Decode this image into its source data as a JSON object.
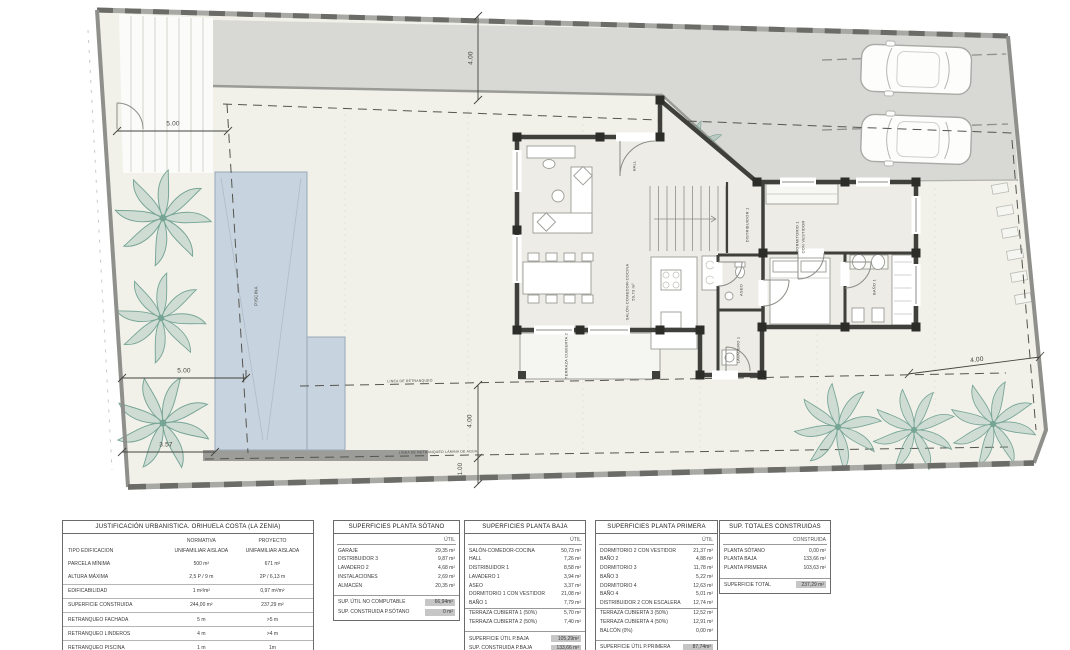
{
  "colors": {
    "pool": "#c7d3de",
    "street": "#d8d8d4",
    "garden": "#f1f1ea",
    "wall": "#3f3f3b",
    "tree": "#76a596",
    "table_shade": "#c6c6c6"
  },
  "plan": {
    "labels": [
      {
        "text": "4.00",
        "x": 471,
        "y": 58,
        "r": -90,
        "fs": 6.5
      },
      {
        "text": "5.00",
        "x": 173,
        "y": 124,
        "r": 0,
        "fs": 6.5
      },
      {
        "text": "5.00",
        "x": 184,
        "y": 371,
        "r": 0,
        "fs": 6.5
      },
      {
        "text": "3.57",
        "x": 166,
        "y": 445,
        "r": 0,
        "fs": 6.5
      },
      {
        "text": "4.00",
        "x": 470,
        "y": 421,
        "r": -90,
        "fs": 6.5
      },
      {
        "text": "1.00",
        "x": 461,
        "y": 469,
        "r": -90,
        "fs": 6
      },
      {
        "text": "4.00",
        "x": 977,
        "y": 360,
        "r": -8,
        "fs": 6.5
      },
      {
        "text": "LÍNEA DE RETRANQUEO",
        "x": 410,
        "y": 381,
        "r": -1,
        "fs": 3.5
      },
      {
        "text": "LÍNEA DE RETRANQUEO LÁMINA DE AGUA",
        "x": 438,
        "y": 452,
        "r": -1,
        "fs": 3.5
      },
      {
        "text": "PISCINA",
        "x": 256,
        "y": 296,
        "r": -90,
        "fs": 4.5
      },
      {
        "text": "SALÓN-COMEDOR-COCINA",
        "x": 627,
        "y": 292,
        "r": -90,
        "fs": 4
      },
      {
        "text": "50,73 m²",
        "x": 633,
        "y": 292,
        "r": -90,
        "fs": 4
      },
      {
        "text": "HALL",
        "x": 634,
        "y": 166,
        "r": -90,
        "fs": 4
      },
      {
        "text": "DISTRIBUIDOR 1",
        "x": 747,
        "y": 225,
        "r": -90,
        "fs": 4
      },
      {
        "text": "ASEO",
        "x": 741,
        "y": 290,
        "r": -90,
        "fs": 4
      },
      {
        "text": "LAVADERO 1",
        "x": 738,
        "y": 350,
        "r": -90,
        "fs": 4
      },
      {
        "text": "DORMITORIO 1",
        "x": 797,
        "y": 237,
        "r": -90,
        "fs": 4
      },
      {
        "text": "CON VESTIDOR",
        "x": 803,
        "y": 237,
        "r": -90,
        "fs": 4
      },
      {
        "text": "BAÑO 1",
        "x": 874,
        "y": 287,
        "r": -90,
        "fs": 4
      },
      {
        "text": "TERRAZA CUBIERTA 2",
        "x": 566,
        "y": 356,
        "r": -90,
        "fs": 4
      }
    ]
  },
  "tables": {
    "urbanistica": {
      "title": "JUSTIFICACIÓN URBANISTICA. ORIHUELA COSTA (LA ZENIA)",
      "col_a": "NORMATIVA",
      "col_b": "PROYECTO",
      "rows": [
        [
          "TIPO EDIFICACION",
          "UNIFAMILIAR AISLADA",
          "UNIFAMILIAR AISLADA"
        ],
        [
          "PARCELA MÍNIMA",
          "500 m²",
          "671 m²"
        ],
        [
          "ALTURA MÁXIMA",
          "2,5 P / 9 m",
          "2P / 6,13 m"
        ],
        [
          "EDIFICABILIDAD",
          "1 m²/m²",
          "0,97 m²/m²"
        ],
        [
          "SUPERFICIE CONSTRUIDA",
          "244,00 m²",
          "237,29 m²"
        ],
        [
          "RETRANQUEO FACHADA",
          "5 m",
          ">5 m"
        ],
        [
          "RETRANQUEO LINDEROS",
          "4 m",
          ">4 m"
        ],
        [
          "RETRANQUEO PISCINA",
          "1 m",
          "1m"
        ]
      ]
    },
    "sotano": {
      "title": "SUPERFICIES PLANTA SÓTANO",
      "col": "ÚTIL",
      "rows": [
        [
          "GARAJE",
          "29,35 m²"
        ],
        [
          "DISTRIBUIDOR 3",
          "9,87 m²"
        ],
        [
          "LAVADERO 2",
          "4,68 m²"
        ],
        [
          "INSTALACIONES",
          "2,69 m²"
        ],
        [
          "ALMACÉN",
          "20,35 m²"
        ]
      ],
      "footer": [
        [
          "SUP. ÚTIL NO COMPUTABLE",
          "66,94m²"
        ],
        [
          "SUP. CONSTRUIDA P.SÓTANO",
          "0 m²"
        ]
      ]
    },
    "baja": {
      "title": "SUPERFICIES PLANTA BAJA",
      "col": "ÚTIL",
      "rows": [
        [
          "SALÓN-COMEDOR-COCINA",
          "50,73 m²"
        ],
        [
          "HALL",
          "7,26 m²"
        ],
        [
          "DISTRIBUIDOR 1",
          "8,58 m²"
        ],
        [
          "LAVADERO 1",
          "3,94 m²"
        ],
        [
          "ASEO",
          "3,37 m²"
        ],
        [
          "DORMITORIO 1 CON VESTIDOR",
          "21,08 m²"
        ],
        [
          "BAÑO 1",
          "7,79 m²"
        ]
      ],
      "rows2": [
        [
          "TERRAZA CUBIERTA 1 (50%)",
          "5,70 m²"
        ],
        [
          "TERRAZA CUBIERTA 2 (50%)",
          "7,40 m²"
        ]
      ],
      "footer": [
        [
          "SUPERFICIE ÚTIL P.BAJA",
          "105,29m²"
        ],
        [
          "SUP. CONSTRUIDA P.BAJA",
          "133,66 m²"
        ]
      ]
    },
    "primera": {
      "title": "SUPERFICIES PLANTA PRIMERA",
      "col": "ÚTIL",
      "rows": [
        [
          "DORMITORIO 2 CON VESTIDOR",
          "21,37 m²"
        ],
        [
          "BAÑO 2",
          "4,88 m²"
        ],
        [
          "DORMITORIO 3",
          "11,78 m²"
        ],
        [
          "BAÑO 3",
          "5,22 m²"
        ],
        [
          "DORMITORIO 4",
          "12,63 m²"
        ],
        [
          "BAÑO 4",
          "5,01 m²"
        ],
        [
          "DISTRIBUIDOR 2 CON ESCALERA",
          "12,74 m²"
        ]
      ],
      "rows2": [
        [
          "TERRAZA CUBIERTA 3 (50%)",
          "12,52 m²"
        ],
        [
          "TERRAZA CUBIERTA 4 (50%)",
          "12,91 m²"
        ],
        [
          "BALCÓN (0%)",
          "0,00 m²"
        ]
      ],
      "footer": [
        [
          "SUPERFICIE ÚTIL P.PRIMERA",
          "87,74m²"
        ],
        [
          "SUP. CONSTRUIDA P.PRIMERA",
          "103,63 m²"
        ]
      ]
    },
    "totales": {
      "title": "SUP. TOTALES CONSTRUIDAS",
      "col": "CONSTRUIDA",
      "rows": [
        [
          "PLANTA SÓTANO",
          "0,00 m²"
        ],
        [
          "PLANTA BAJA",
          "133,66 m²"
        ],
        [
          "PLANTA PRIMERA",
          "103,63 m²"
        ]
      ],
      "footer": [
        [
          "SUPERFICIE TOTAL",
          "237,29 m²"
        ]
      ]
    }
  }
}
